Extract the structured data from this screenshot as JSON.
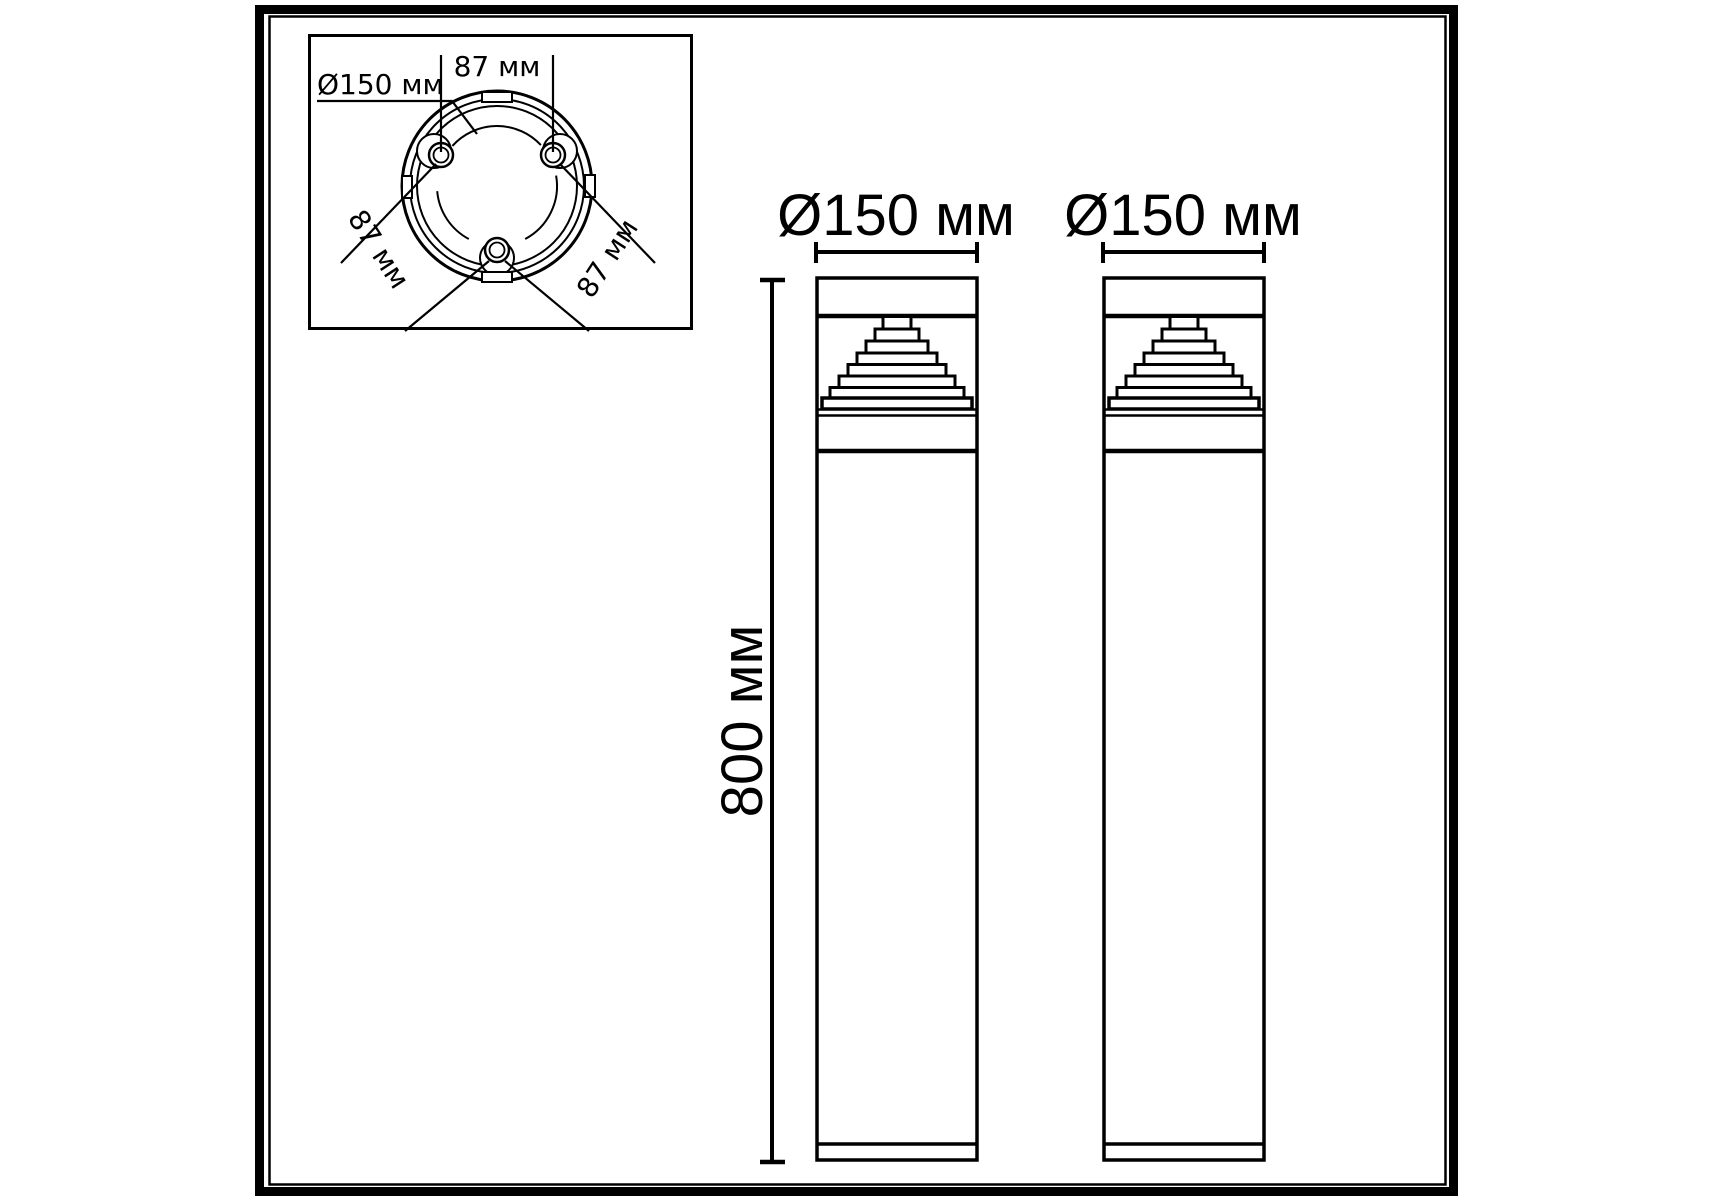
{
  "page": {
    "background_color": "#ffffff",
    "line_color": "#000000",
    "content": "technical dimension drawing of cylindrical bollard light, top view and two front views"
  },
  "top_view": {
    "diameter_label": "Ø150 мм",
    "spacing_top_label": "87 мм",
    "spacing_left_label": "87 мм",
    "spacing_right_label": "87 мм"
  },
  "side_view": {
    "bollard1_diameter_label": "Ø150 мм",
    "bollard2_diameter_label": "Ø150 мм",
    "height_label": "800 мм"
  }
}
